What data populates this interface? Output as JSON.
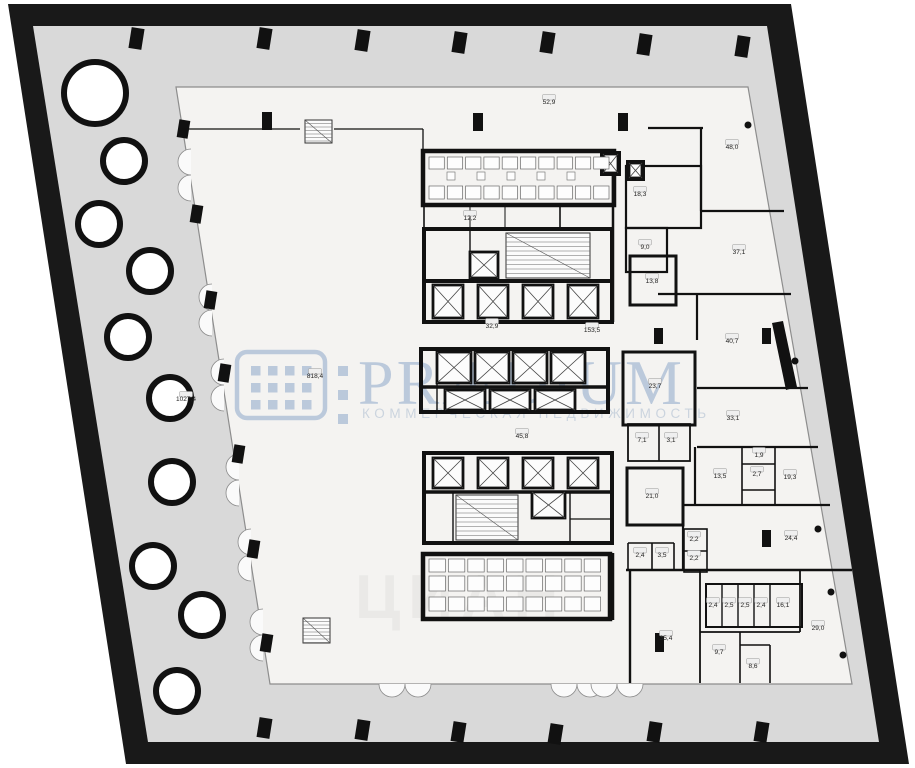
{
  "watermark": {
    "brand": "PRÆDIUM",
    "tagline": "КОММЕРЧЕСКАЯ НЕДВИЖИМОСТЬ",
    "color": "#aebfd6"
  },
  "watermark_secondary": {
    "text": "ЦИАН"
  },
  "colors": {
    "frame": "#191919",
    "terrace": "#d9d9d9",
    "floor": "#f4f3f1",
    "wall": "#111111"
  },
  "plan": {
    "terrace_area_label": "1027,4",
    "open_space_label": "818,4",
    "rooms": [
      {
        "area": "52,9",
        "x": 549,
        "y": 104
      },
      {
        "area": "48,0",
        "x": 732,
        "y": 149
      },
      {
        "area": "12,2",
        "x": 470,
        "y": 220
      },
      {
        "area": "18,3",
        "x": 640,
        "y": 196
      },
      {
        "area": "9,0",
        "x": 645,
        "y": 249
      },
      {
        "area": "37,1",
        "x": 739,
        "y": 254
      },
      {
        "area": "13,8",
        "x": 652,
        "y": 283
      },
      {
        "area": "32,9",
        "x": 492,
        "y": 328
      },
      {
        "area": "153,5",
        "x": 592,
        "y": 332
      },
      {
        "area": "40,7",
        "x": 732,
        "y": 343
      },
      {
        "area": "818,4",
        "x": 315,
        "y": 378
      },
      {
        "area": "1027,4",
        "x": 186,
        "y": 401
      },
      {
        "area": "23,7",
        "x": 655,
        "y": 388
      },
      {
        "area": "33,1",
        "x": 733,
        "y": 420
      },
      {
        "area": "7,1",
        "x": 642,
        "y": 442
      },
      {
        "area": "3,1",
        "x": 671,
        "y": 442
      },
      {
        "area": "45,8",
        "x": 522,
        "y": 438
      },
      {
        "area": "1,9",
        "x": 759,
        "y": 457
      },
      {
        "area": "13,5",
        "x": 720,
        "y": 478
      },
      {
        "area": "2,7",
        "x": 757,
        "y": 476
      },
      {
        "area": "19,3",
        "x": 790,
        "y": 479
      },
      {
        "area": "21,0",
        "x": 652,
        "y": 498
      },
      {
        "area": "24,4",
        "x": 791,
        "y": 540
      },
      {
        "area": "2,2",
        "x": 694,
        "y": 541
      },
      {
        "area": "2,2",
        "x": 694,
        "y": 560
      },
      {
        "area": "2,4",
        "x": 640,
        "y": 557
      },
      {
        "area": "3,5",
        "x": 662,
        "y": 557
      },
      {
        "area": "2,4",
        "x": 713,
        "y": 607
      },
      {
        "area": "2,5",
        "x": 729,
        "y": 607
      },
      {
        "area": "2,5",
        "x": 745,
        "y": 607
      },
      {
        "area": "2,4",
        "x": 761,
        "y": 607
      },
      {
        "area": "16,1",
        "x": 783,
        "y": 607
      },
      {
        "area": "35,4",
        "x": 666,
        "y": 640
      },
      {
        "area": "9,7",
        "x": 719,
        "y": 654
      },
      {
        "area": "8,6",
        "x": 753,
        "y": 668
      },
      {
        "area": "29,0",
        "x": 818,
        "y": 630
      }
    ]
  }
}
